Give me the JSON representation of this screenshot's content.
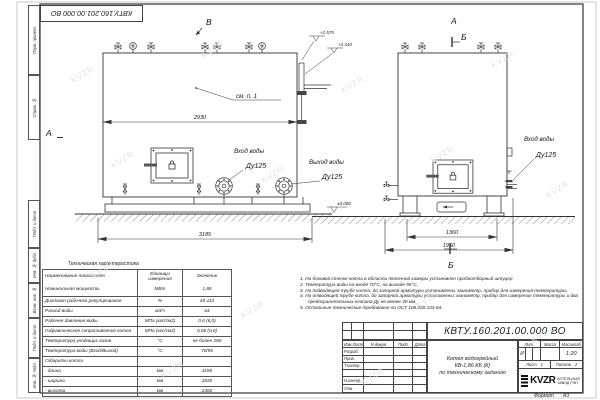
{
  "colors": {
    "line": "#3a3a3a",
    "paper": "#ffffff"
  },
  "watermark": "KVZR",
  "frame": {
    "margin_labels_top": [
      "Перв. примен.",
      "Справ. №"
    ],
    "margin_labels_bottom": [
      "Подп. и дата",
      "Инв. № дубл.",
      "Взам. инв. №",
      "Подп. и дата",
      "Инв. № подл."
    ]
  },
  "drawing": {
    "markers": {
      "view_v": "В",
      "view_a_top": "А",
      "section_b_top": "Б",
      "view_a_left": "А",
      "section_b_bottom": "Б"
    },
    "elevations": {
      "pipe_top": "+2.575",
      "pipe_mid": "+2.410",
      "ground": "±0.000"
    },
    "dimensions": {
      "boiler_width": "2930",
      "base_length": "3185",
      "side_span": "1360",
      "side_base": "1950"
    },
    "callouts": {
      "see_note": "см. п. 1",
      "water_inlet_front": {
        "line1": "Вход воды",
        "line2": "Ду125"
      },
      "water_outlet": {
        "line1": "Выход воды",
        "line2": "Ду125"
      },
      "water_inlet_side": {
        "line1": "Вход воды",
        "line2": "Ду125"
      }
    }
  },
  "spec_table": {
    "title": "Техническая характеристика",
    "headers": [
      "Наименование показателя",
      "Единицы измерения",
      "Значение"
    ],
    "rows": [
      [
        "Номинальная мощность",
        "МВт",
        "1,86"
      ],
      [
        "Диапазон рабочего регулирования",
        "%",
        "40-110"
      ],
      [
        "Расход воды",
        "м3/ч",
        "64"
      ],
      [
        "Рабочее давление воды",
        "МПа (кгс/см2)",
        "0,6 (6,0)"
      ],
      [
        "Гидравлическое сопротивление котла",
        "МПа (кгс/см2)",
        "0,06 (0,6)"
      ],
      [
        "Температура уходящих газов",
        "°С",
        "не более 280"
      ],
      [
        "Температура воды (Вход/Выход)",
        "°С",
        "70/95"
      ],
      [
        "Габариты котла",
        "",
        ""
      ],
      [
        "- длина",
        "мм",
        "3185"
      ],
      [
        "- ширина",
        "мм",
        "1830"
      ],
      [
        "- высота",
        "мм",
        "2460"
      ]
    ]
  },
  "notes": [
    "1. На боковой стенке котла в области топочной камеры установлен пробоотборный штуцер",
    "2. Температура воды на входе 70°С, на выходе 95°С.",
    "3. На подводящей трубе котла, до запорной арматуры установлены: манометр, прибор для измерения температуры.",
    "4. На отводящей трубе котла, до запорной арматуры установлены: манометр, прибор для измерения температуры и два предохранительных клапана Ду не менее 40 мм.",
    "5. Остальные технические требования по ОСТ 108.030.133-84."
  ],
  "title_block": {
    "designation": "КВТУ.160.201.00.000  ВО",
    "doc_title_lines": [
      "Котел водогрейный",
      "КВ-1,86 КБ (К)",
      "по техническому заданию"
    ],
    "header_cells": [
      "Изм.Лист",
      "N докум.",
      "Подп.",
      "Дата"
    ],
    "row_labels": [
      "Разраб.",
      "Пров.",
      "Т.контр.",
      "",
      "Н.контр.",
      "Утв."
    ],
    "lit_label": "Лит.",
    "mass_label": "Масса",
    "scale_label": "Масштаб",
    "lit_value": "И",
    "scale_value": "1:20",
    "sheet_label": "Лист",
    "sheet_value": "1",
    "sheets_label": "Листов",
    "sheets_value": "2",
    "logo_text": "KVZR",
    "company_lines": [
      "КОТЕЛЬНЫЙ",
      "ЗАВОД РЭП"
    ],
    "format_label": "Формат",
    "format_value": "А3"
  }
}
